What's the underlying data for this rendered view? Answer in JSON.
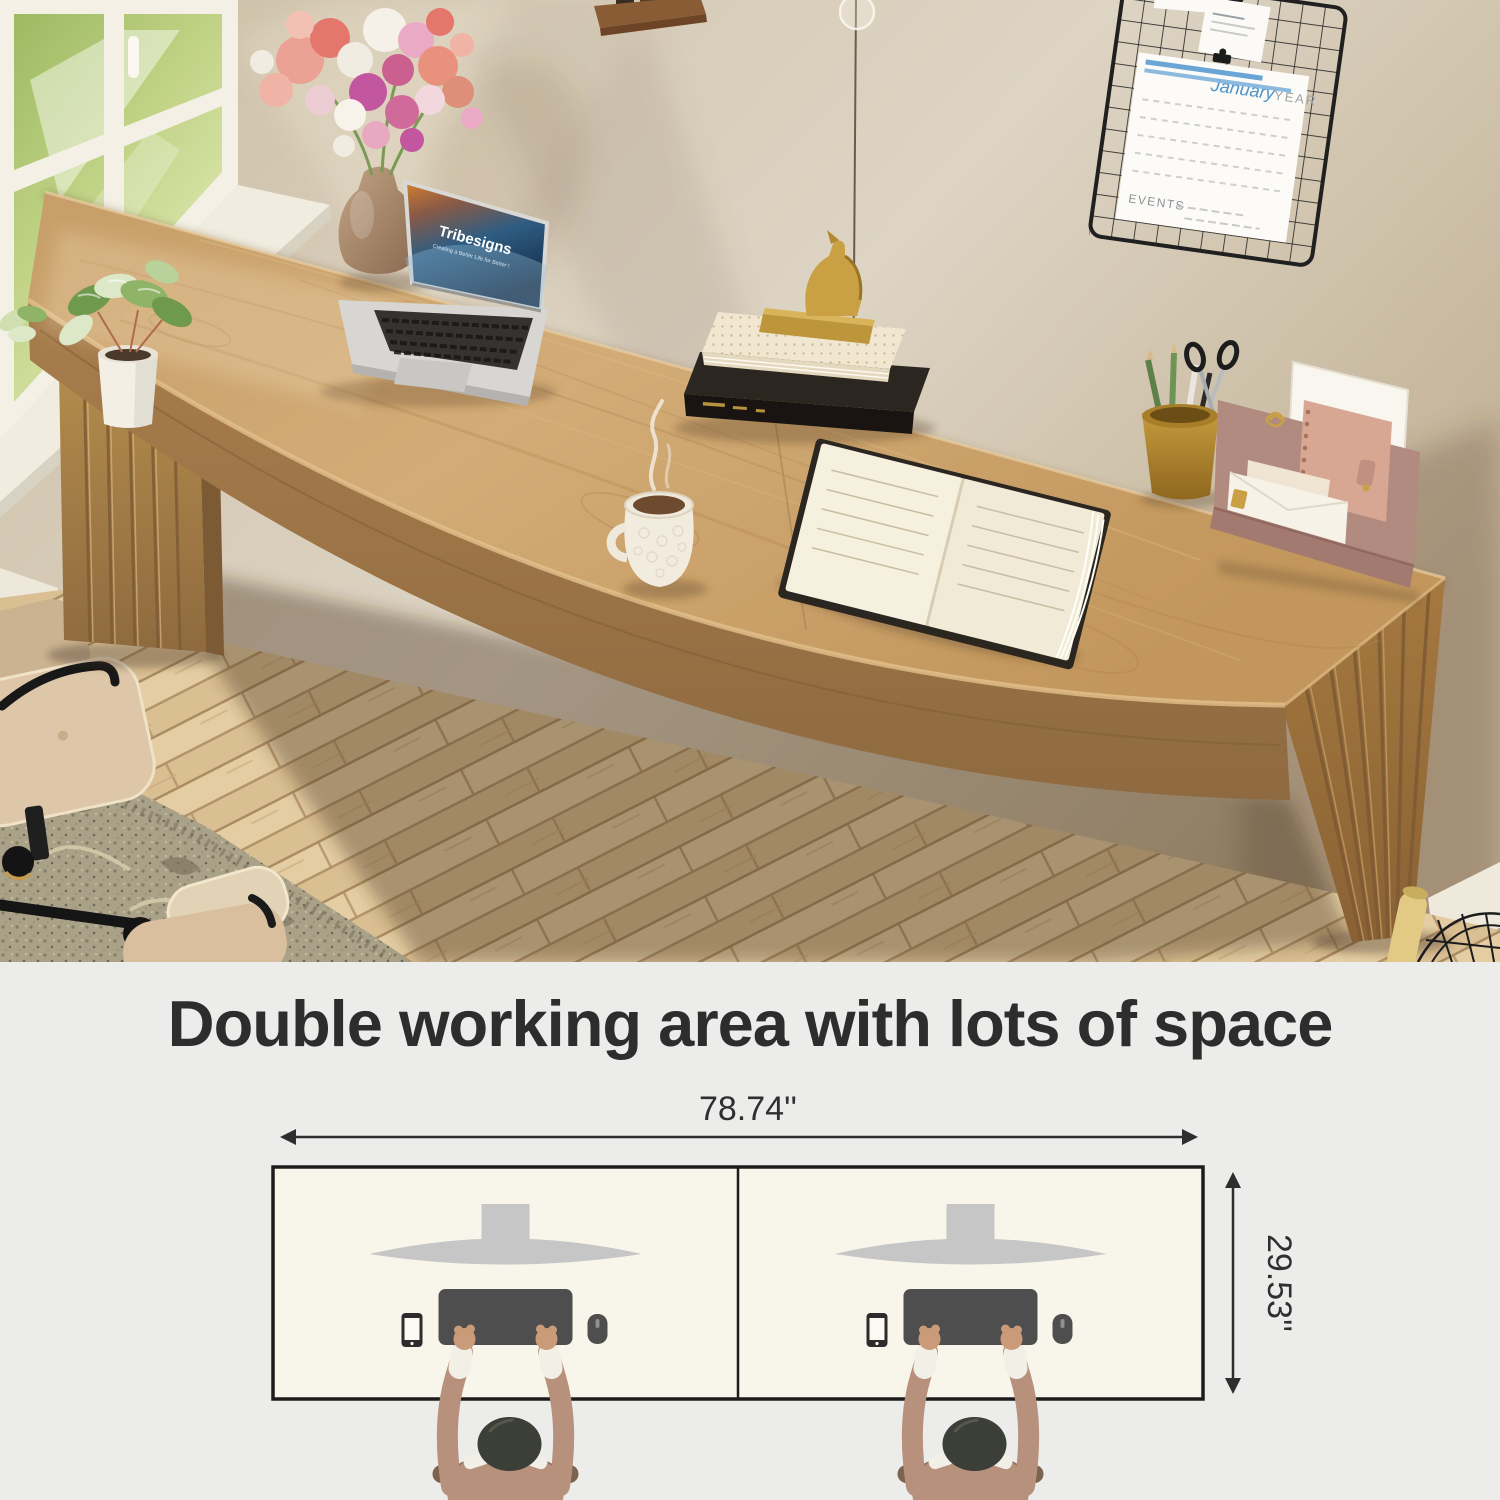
{
  "photo": {
    "laptop_screen": {
      "brand": "Tribesigns",
      "tagline": "Creating a Better Life for Better !"
    },
    "wall_calendar": {
      "month": "January",
      "year_label": "YEAR",
      "events_label": "EVENTS"
    }
  },
  "info_panel": {
    "title": "Double working area with lots of space",
    "width_label": "78.74''",
    "depth_label": "29.53''",
    "colors": {
      "panel_background": "#ececeb",
      "desk_diagram_fill": "#f8f5ea",
      "outline": "#1c1c1c",
      "monitor_gray": "#c6c6c6",
      "device_gray": "#4e4e4e",
      "shirt_tan": "#b7917b",
      "skin": "#c99b78",
      "desk_wood": "#c59d67"
    }
  }
}
